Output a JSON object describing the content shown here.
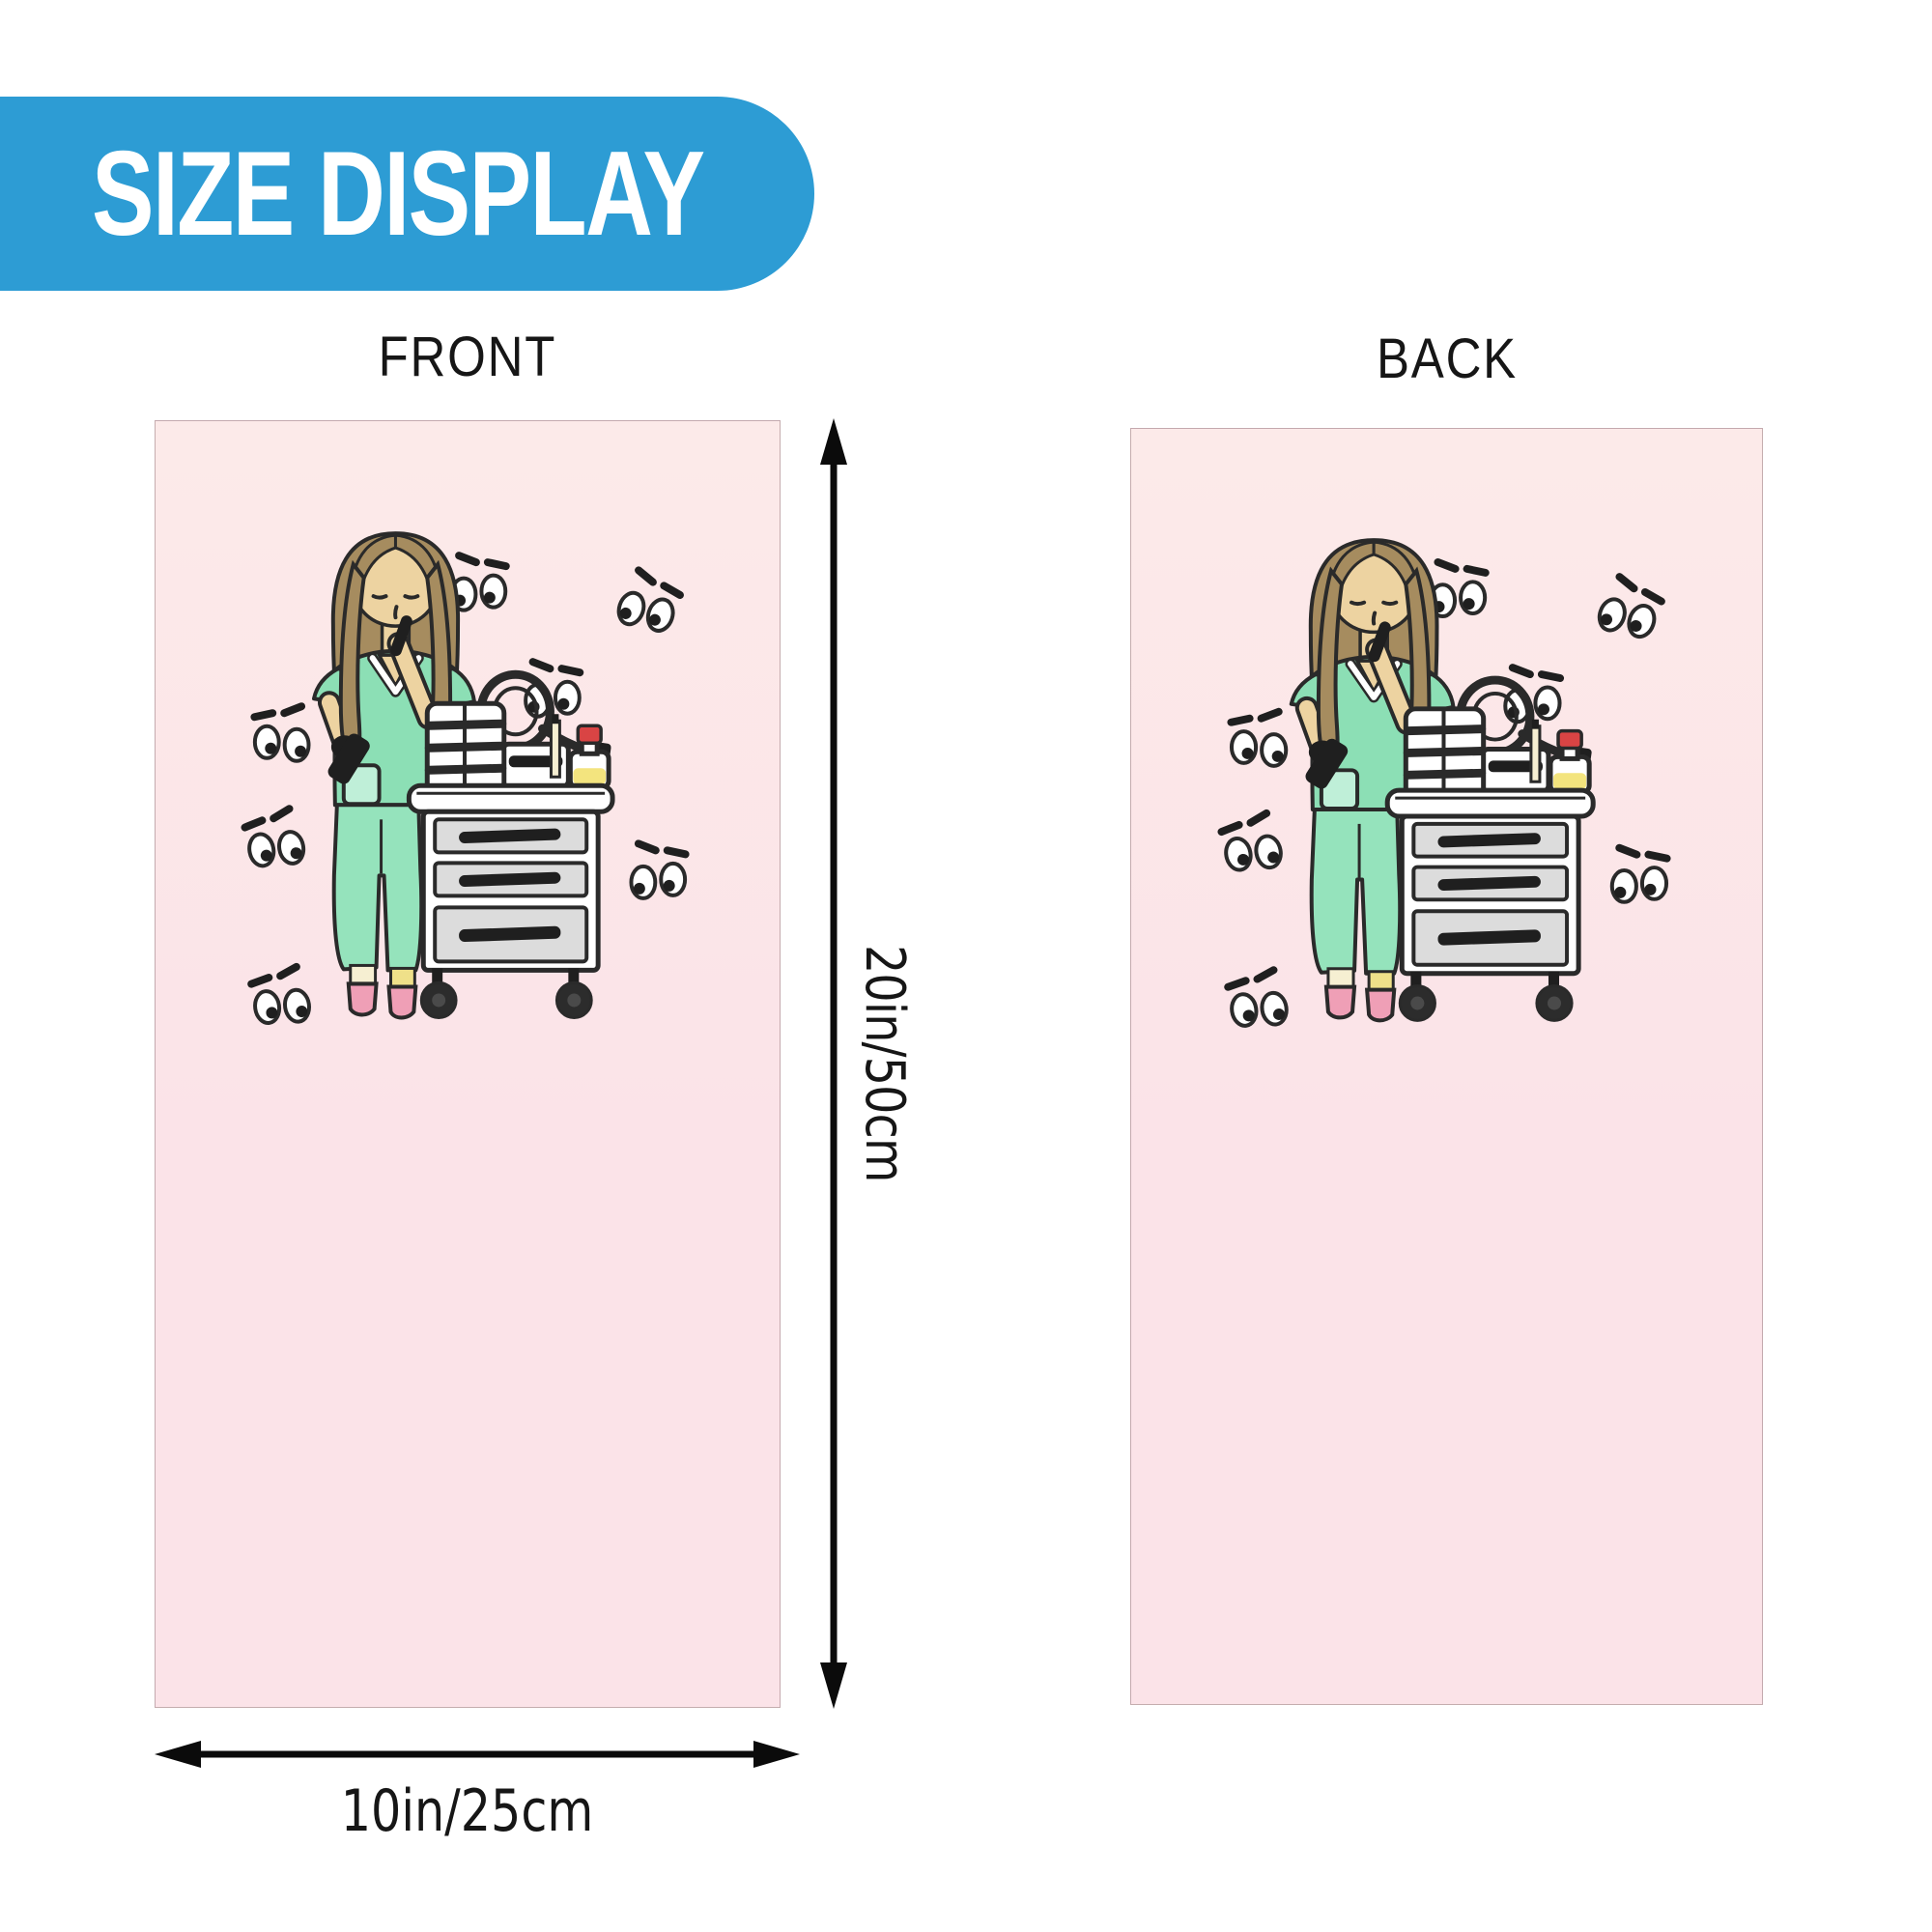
{
  "badge": {
    "label": "SIZE DISPLAY"
  },
  "panels": [
    {
      "side_label": "FRONT"
    },
    {
      "side_label": "BACK"
    }
  ],
  "dimensions": {
    "height_label": "20in/50cm",
    "width_label": "10in/25cm"
  },
  "illustration": {
    "name": "nurse-shh-with-medical-cart-and-watching-eyes"
  },
  "colors": {
    "accent_blue": "#2D9CD4",
    "badge_text": "#FFFFFF",
    "label_ink": "#161616",
    "panel_pink_top": "#FCEAE9",
    "panel_pink": "#FBE3E8",
    "outline_ink": "#2A2A2A",
    "arrow_ink": "#0B0B0B",
    "hair_brown": "#A68C5F",
    "skin_tan": "#EDD3A1",
    "scrub_green": "#8CDFB5",
    "pants_green": "#95E3BC",
    "pocket_green": "#BFEFD8",
    "shoe_pink": "#EF9FB6",
    "sock_cream": "#F6EFD2",
    "sock_yellow": "#EFE089",
    "drawer_gray": "#DCDCDC",
    "item_dark": "#1F1F1F",
    "wheel_dark": "#2C2C2C",
    "bottle_red": "#D94444",
    "bottle_yellow": "#F3E47E",
    "towel_white": "#FFFFFF"
  }
}
